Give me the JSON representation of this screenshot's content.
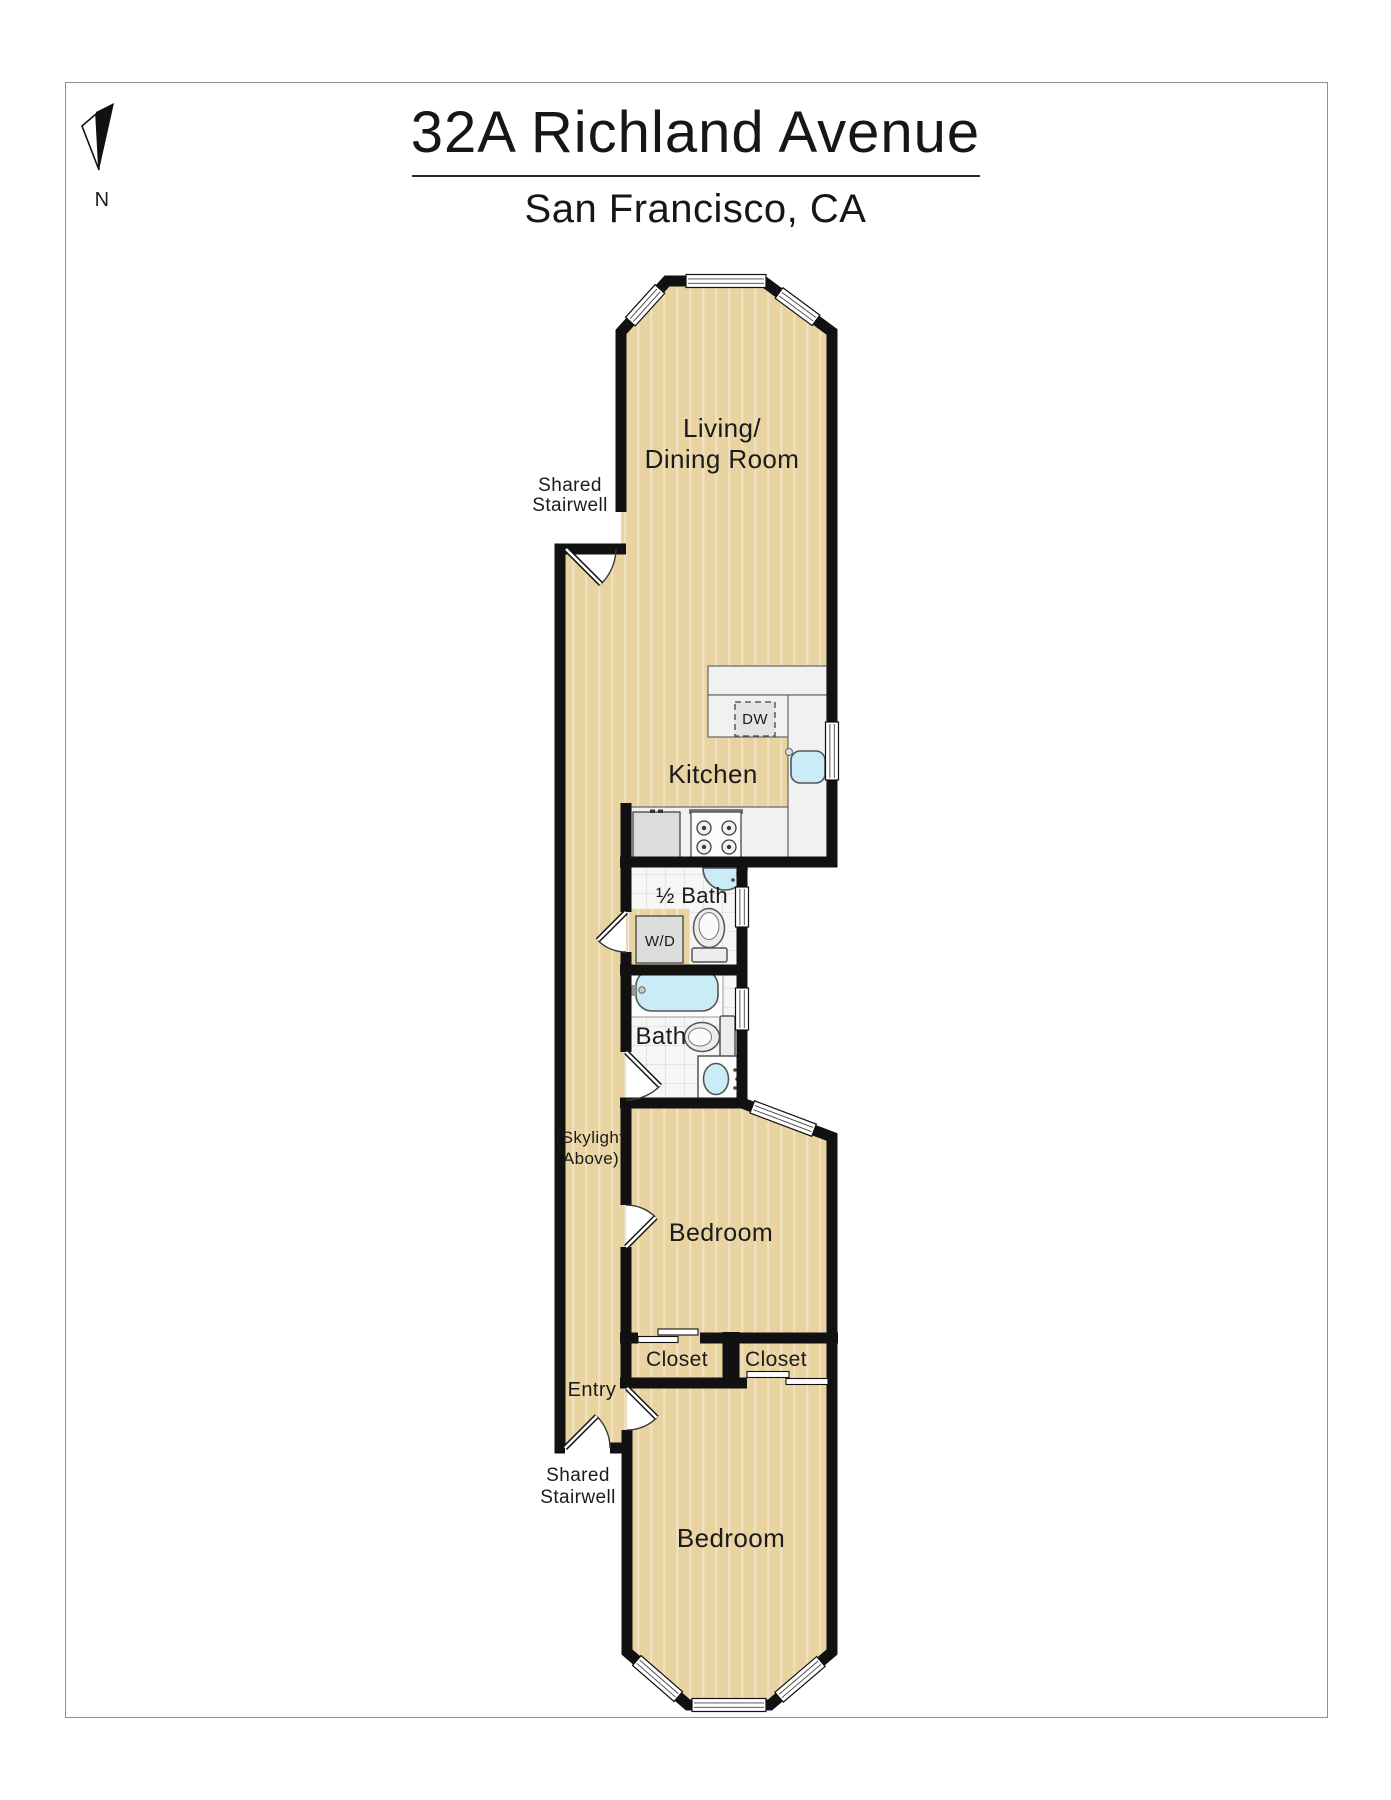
{
  "header": {
    "title": "32A Richland Avenue",
    "subtitle": "San Francisco, CA",
    "compass": "N"
  },
  "labels": {
    "living_1": "Living/",
    "living_2": "Dining Room",
    "kitchen": "Kitchen",
    "dishwasher": "DW",
    "half_bath": "½ Bath",
    "washer_dryer": "W/D",
    "bath": "Bath",
    "skylight_1": "(Skylight",
    "skylight_2": "Above)",
    "stairwell_top_1": "Shared",
    "stairwell_top_2": "Stairwell",
    "bedroom_middle": "Bedroom",
    "closet_left": "Closet",
    "closet_right": "Closet",
    "entry": "Entry",
    "stairwell_bottom_1": "Shared",
    "stairwell_bottom_2": "Stairwell",
    "bedroom_bottom": "Bedroom"
  },
  "colors": {
    "wall": "#111111",
    "floor_wood": "#e9d3a1",
    "floor_wood_stripe": "#eee1c0",
    "tile": "#f6f6f5",
    "tile_grid": "#d9d9d9",
    "fixture_water": "#c9ecf6",
    "counter": "#f1f1f1",
    "appliance": "#dcdcdc"
  }
}
